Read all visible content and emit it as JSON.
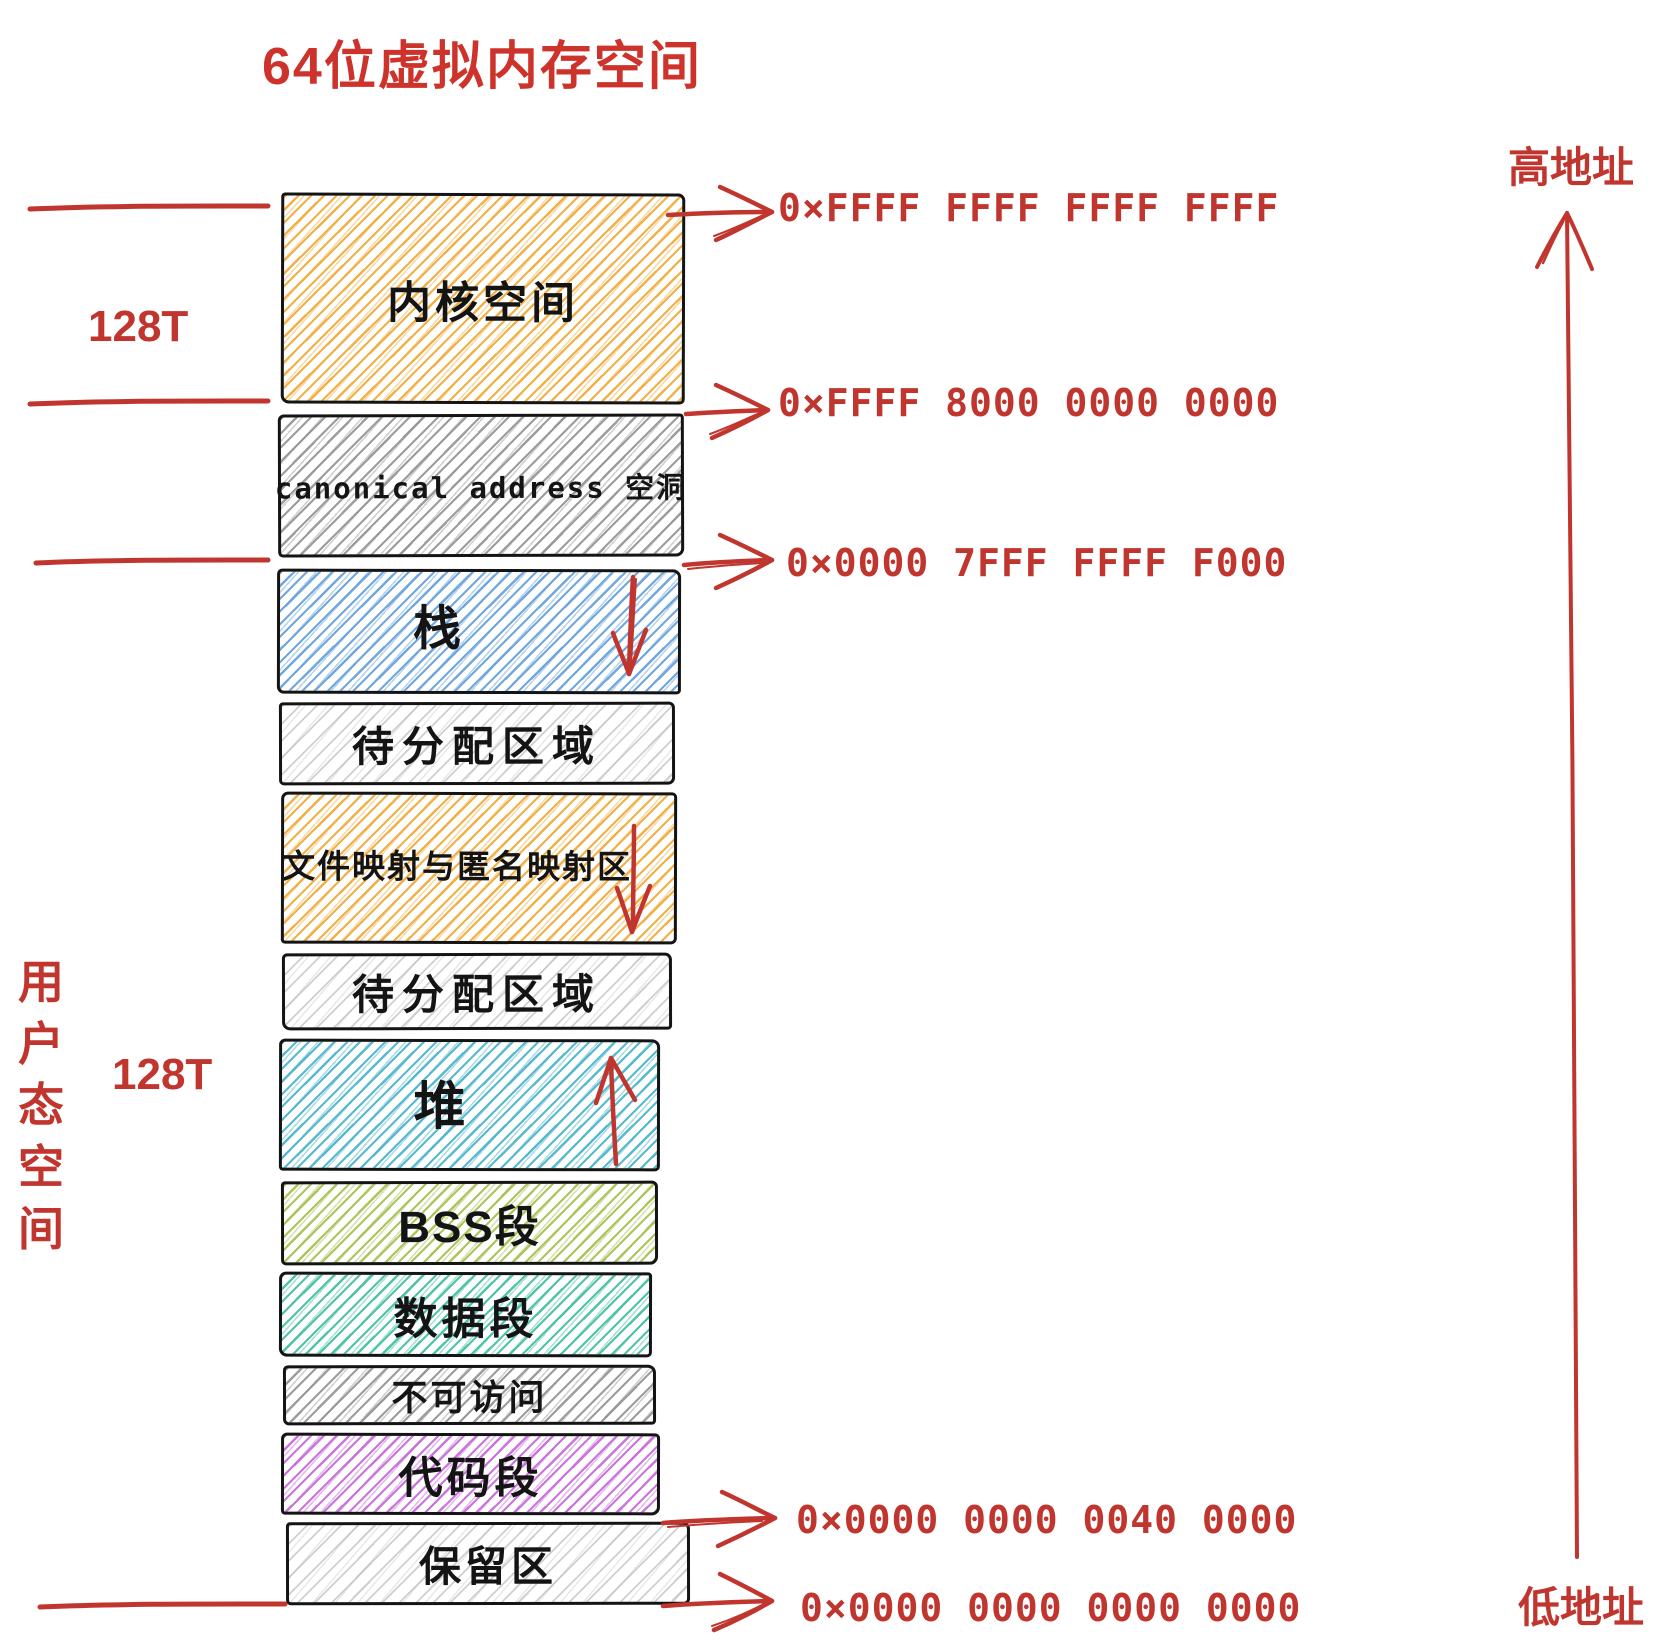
{
  "title": "64位虚拟内存空间",
  "colors": {
    "annotation_red": "#c1352f",
    "title_red": "#cd332b",
    "border_black": "#141414",
    "kernel_hatch": "#f0ad3e",
    "canonical_hatch": "#8c8c8c",
    "stack_hatch": "#639fd9",
    "unallocated_hatch": "#afafb6",
    "filemap_hatch": "#f0ad3e",
    "heap_hatch": "#46b3c9",
    "bss_hatch": "#a2c04a",
    "data_hatch": "#3ebe9e",
    "noaccess_hatch": "#8c8c8c",
    "code_hatch": "#c567d8",
    "reserved_hatch": "#afafb6"
  },
  "left_labels": {
    "kernel_size": "128T",
    "user_size": "128T",
    "user_space": "用户态空间"
  },
  "right_labels": {
    "high_address": "高地址",
    "low_address": "低地址"
  },
  "regions": [
    {
      "label": "内核空间",
      "hatch": "#f0ad3e",
      "growth_arrow": null
    },
    {
      "label": "canonical address 空洞",
      "hatch": "#8c8c8c",
      "growth_arrow": null
    },
    {
      "label": "栈",
      "hatch": "#639fd9",
      "growth_arrow": "down"
    },
    {
      "label": "待分配区域",
      "hatch": "#afafb6",
      "growth_arrow": null
    },
    {
      "label": "文件映射与匿名映射区",
      "hatch": "#f0ad3e",
      "growth_arrow": "down"
    },
    {
      "label": "待分配区域",
      "hatch": "#afafb6",
      "growth_arrow": null
    },
    {
      "label": "堆",
      "hatch": "#46b3c9",
      "growth_arrow": "up"
    },
    {
      "label": "BSS段",
      "hatch": "#a2c04a",
      "growth_arrow": null
    },
    {
      "label": "数据段",
      "hatch": "#3ebe9e",
      "growth_arrow": null
    },
    {
      "label": "不可访问",
      "hatch": "#8c8c8c",
      "growth_arrow": null
    },
    {
      "label": "代码段",
      "hatch": "#c567d8",
      "growth_arrow": null
    },
    {
      "label": "保留区",
      "hatch": "#afafb6",
      "growth_arrow": null
    }
  ],
  "addresses": [
    {
      "value": "0×FFFF FFFF FFFF FFFF"
    },
    {
      "value": "0×FFFF 8000 0000 0000"
    },
    {
      "value": "0×0000 7FFF FFFF F000"
    },
    {
      "value": "0×0000 0000 0040 0000"
    },
    {
      "value": "0×0000 0000 0000 0000"
    }
  ]
}
